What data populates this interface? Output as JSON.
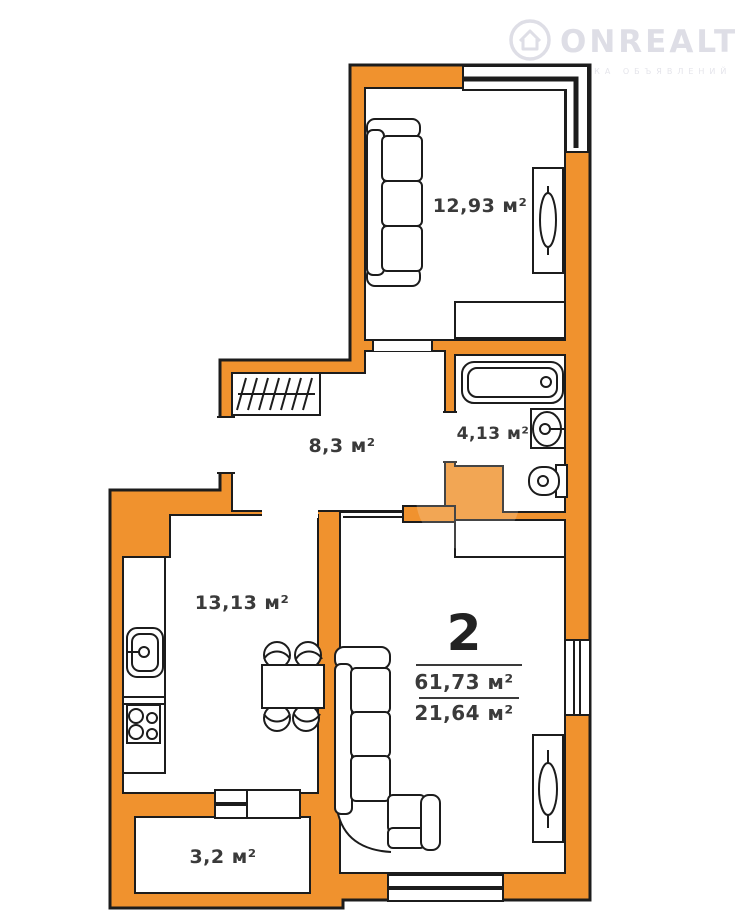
{
  "watermark": {
    "brand": "ONREALT",
    "subtitle": "ДОСКА ОБЪЯВЛЕНИЙ"
  },
  "apartment": {
    "rooms_count": "2",
    "total_area": "61,73 м²",
    "living_area": "21,64 м²"
  },
  "rooms": {
    "bedroom": {
      "area": "12,93 м²"
    },
    "hallway": {
      "area": "8,3 м²"
    },
    "bathroom": {
      "area": "4,13 м²"
    },
    "kitchen": {
      "area": "13,13 м²"
    },
    "balcony": {
      "area": "3,2 м²"
    }
  },
  "colors": {
    "wall": "#F0922E",
    "outline": "#1C1C1C",
    "label": "#3A3A3A",
    "watermark": "#DEDEE6"
  }
}
